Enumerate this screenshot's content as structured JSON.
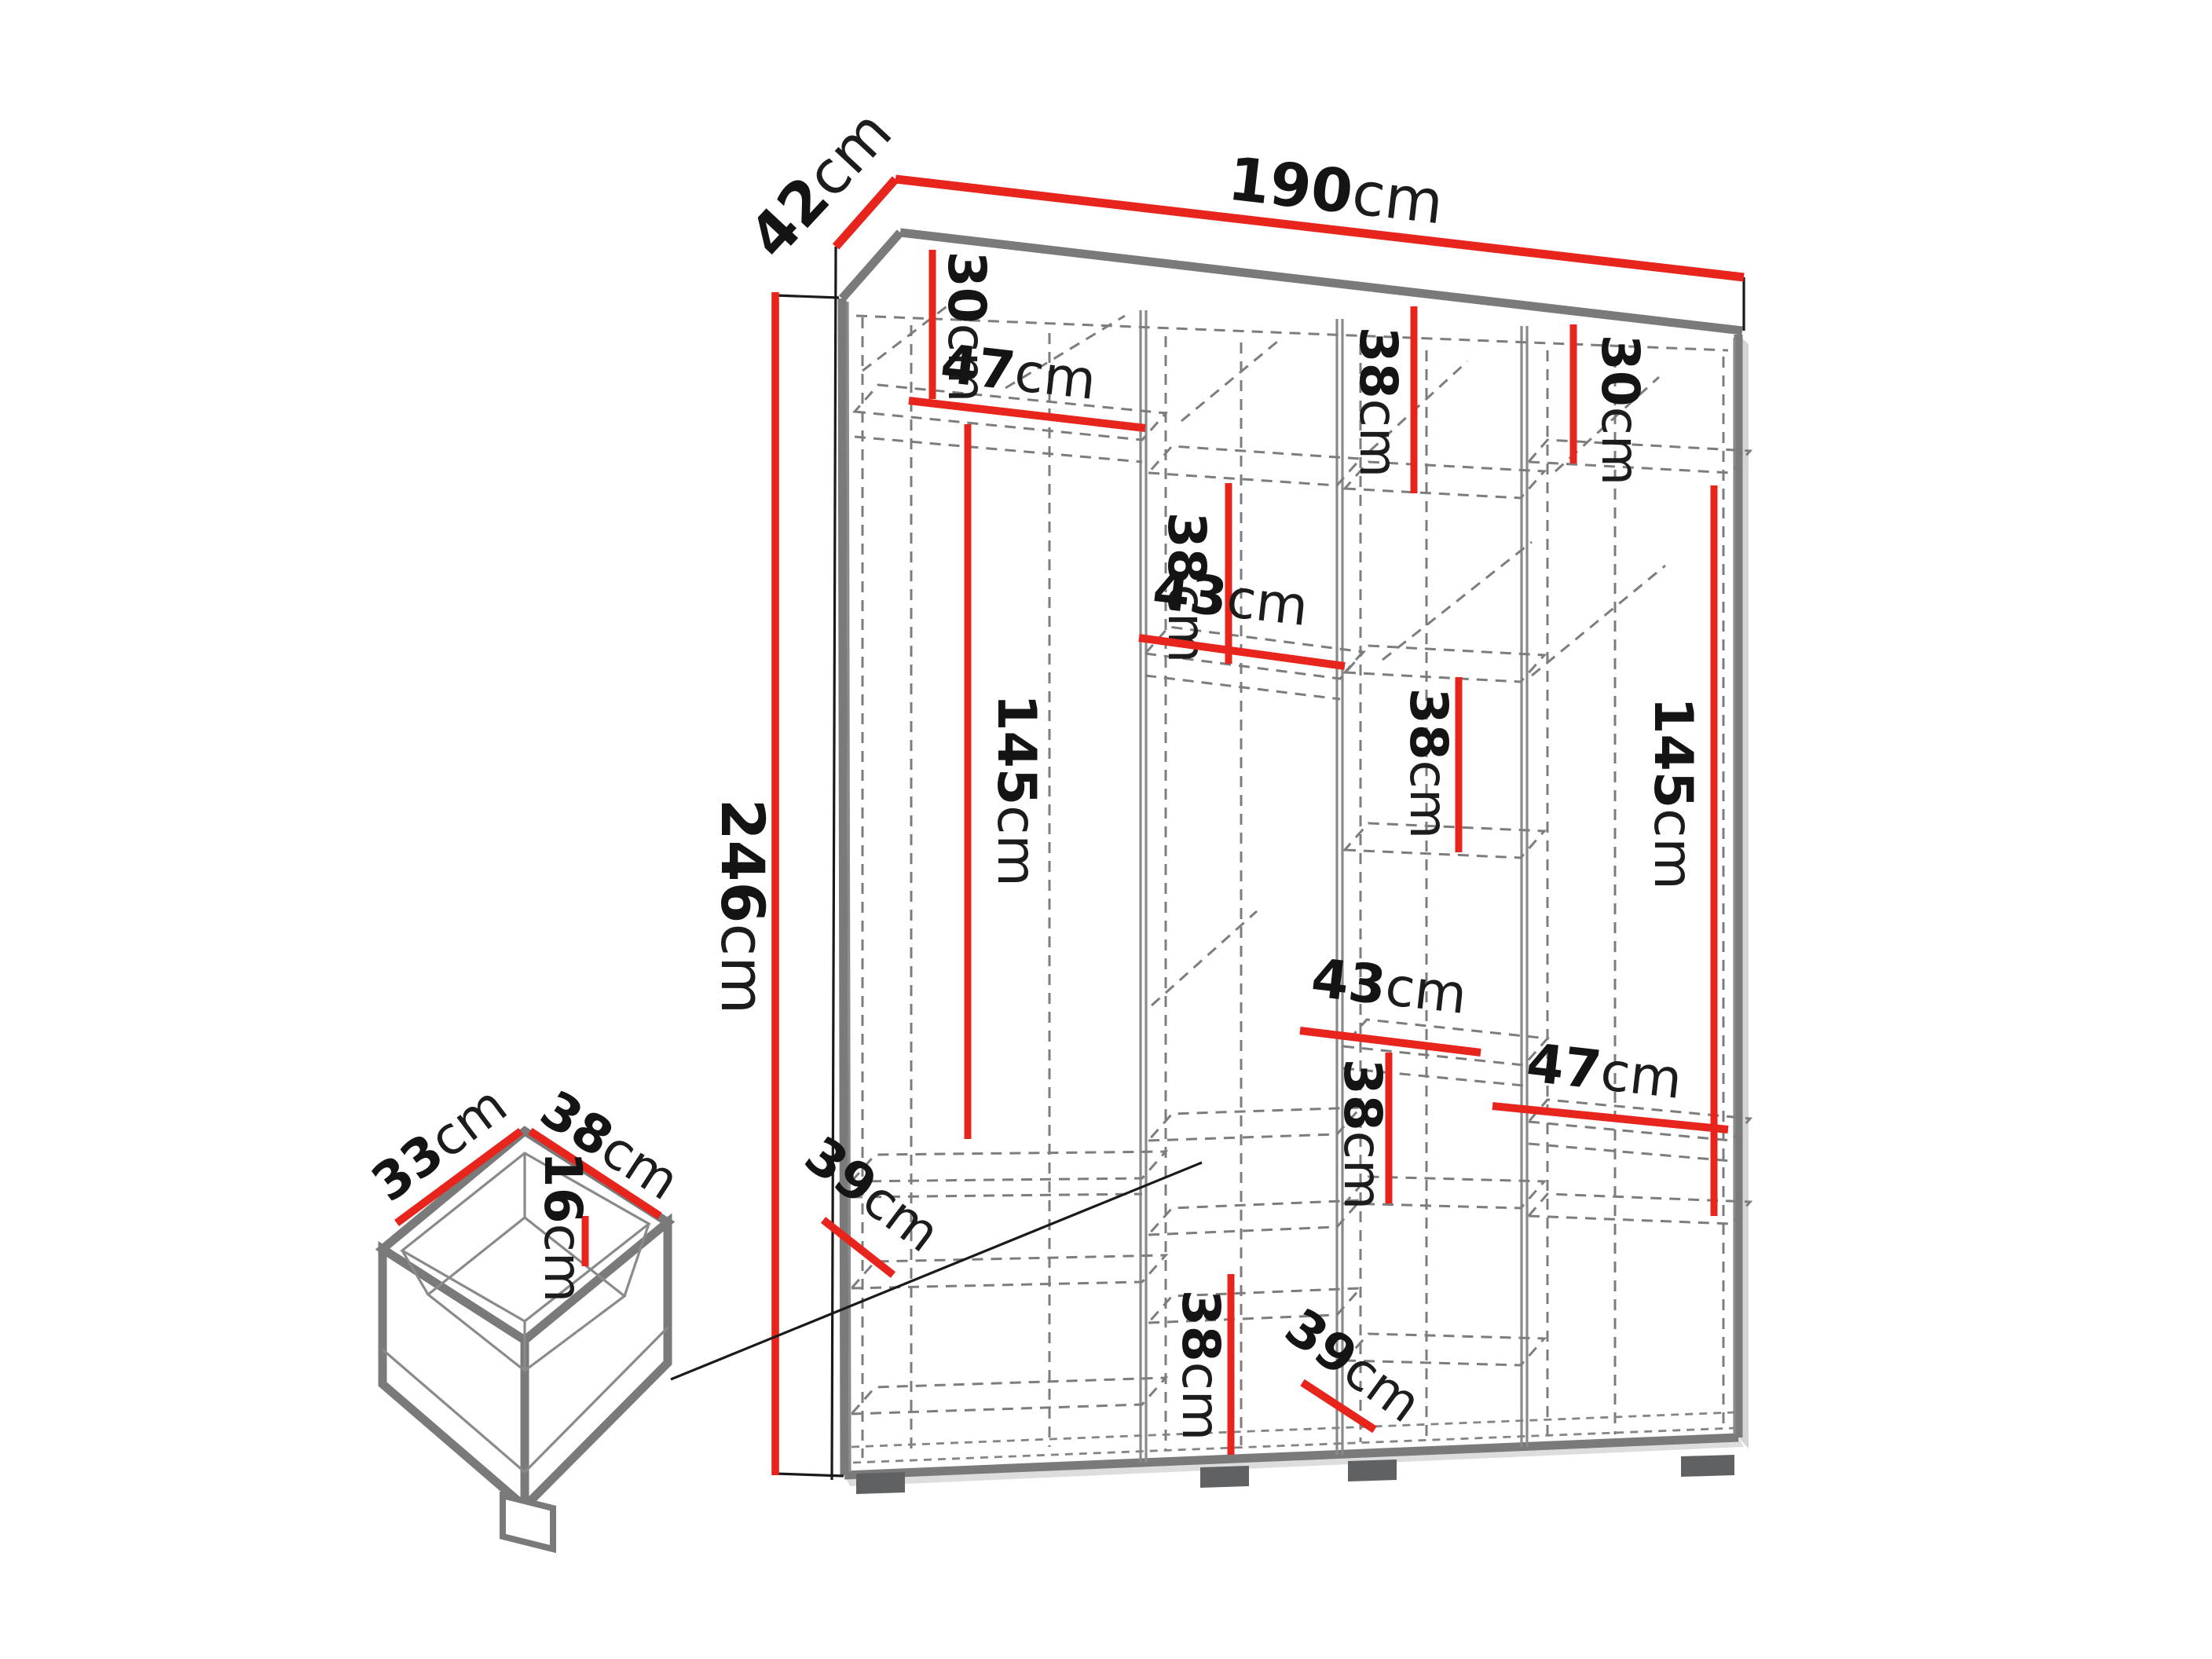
{
  "diagram": {
    "kind": "wardrobe-dimension-diagram",
    "unit": "cm",
    "colors": {
      "dimension_accent": "#e8251d",
      "structure_gray": "#7a7a7a",
      "label_text": "#141414"
    },
    "dims": {
      "width": {
        "num": "190",
        "unit": "cm"
      },
      "depth": {
        "num": "42",
        "unit": "cm"
      },
      "height": {
        "num": "246",
        "unit": "cm"
      },
      "left_top": {
        "num": "30",
        "unit": "cm"
      },
      "left_shelf": {
        "num": "47",
        "unit": "cm"
      },
      "left_section": {
        "num": "145",
        "unit": "cm"
      },
      "left_bottom": {
        "num": "39",
        "unit": "cm"
      },
      "mid1_gap": {
        "num": "38",
        "unit": "cm"
      },
      "mid1_shelf": {
        "num": "43",
        "unit": "cm"
      },
      "mid1_bottom": {
        "num": "38",
        "unit": "cm"
      },
      "mid2_top": {
        "num": "38",
        "unit": "cm"
      },
      "mid2_gap": {
        "num": "38",
        "unit": "cm"
      },
      "mid2_shelf": {
        "num": "43",
        "unit": "cm"
      },
      "mid2_lower": {
        "num": "38",
        "unit": "cm"
      },
      "mid2_bottom": {
        "num": "39",
        "unit": "cm"
      },
      "right_top": {
        "num": "30",
        "unit": "cm"
      },
      "right_section": {
        "num": "145",
        "unit": "cm"
      },
      "right_shelf": {
        "num": "47",
        "unit": "cm"
      },
      "drawer_depth": {
        "num": "33",
        "unit": "cm"
      },
      "drawer_width": {
        "num": "38",
        "unit": "cm"
      },
      "drawer_height": {
        "num": "16",
        "unit": "cm"
      }
    }
  }
}
